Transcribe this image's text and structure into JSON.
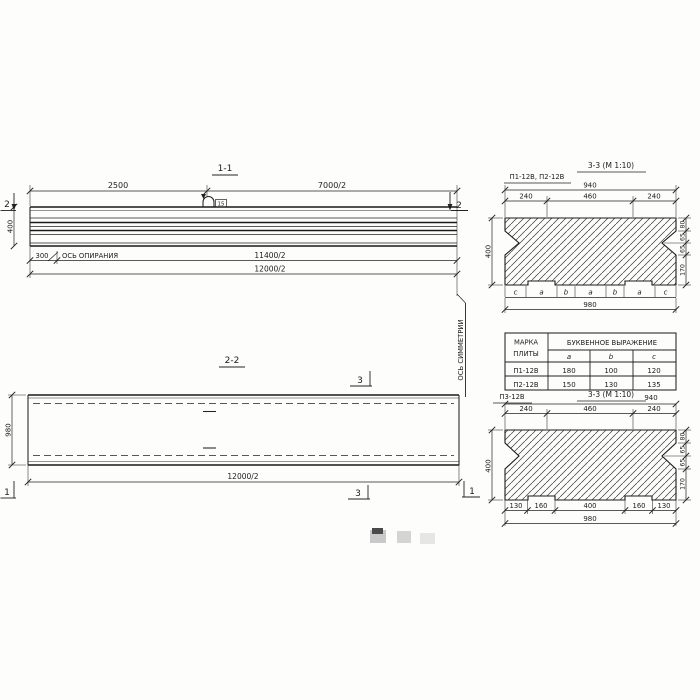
{
  "drawing": {
    "elevation": {
      "title": "1-1",
      "dim_2500": "2500",
      "dim_7000_2": "7000/2",
      "dim_400": "400",
      "dim_300": "300",
      "support_axis": "ОСЬ ОПИРАНИЯ",
      "dim_11400_2": "11400/2",
      "dim_12000_2": "12000/2",
      "marker_left": "2",
      "marker_right": "2",
      "loop_tag": "15"
    },
    "symmetry_axis": "ОСЬ СИММЕТРИИ",
    "plan": {
      "title": "2-2",
      "dim_980": "980",
      "dim_12000_2": "12000/2",
      "marker_top": "3",
      "marker_bottom": "3",
      "marker_left": "1",
      "marker_right": "1"
    },
    "section_a": {
      "label": "П1-12В, П2-12В",
      "title": "3-3 (М 1:10)",
      "dim_940": "940",
      "top_dims": [
        "240",
        "460",
        "240"
      ],
      "left_dim": "400",
      "right_dims": [
        "80",
        "65",
        "65",
        "170"
      ],
      "letters": [
        "c",
        "a",
        "b",
        "a",
        "b",
        "a",
        "c"
      ],
      "dim_980": "980"
    },
    "table": {
      "header_mark_1": "МАРКА",
      "header_mark_2": "ПЛИТЫ",
      "header_expr": "БУКВЕННОЕ  ВЫРАЖЕНИЕ",
      "cols": [
        "a",
        "b",
        "c"
      ],
      "rows": [
        {
          "mark": "П1-12В",
          "a": "180",
          "b": "100",
          "c": "120"
        },
        {
          "mark": "П2-12В",
          "a": "150",
          "b": "130",
          "c": "135"
        }
      ]
    },
    "section_b": {
      "label": "П3-12В",
      "title": "3-3 (М 1:10)",
      "dim_940": "940",
      "top_dims": [
        "240",
        "460",
        "240"
      ],
      "left_dim": "400",
      "right_dims": [
        "80",
        "65",
        "65",
        "170"
      ],
      "bottom_dims": [
        "130",
        "160",
        "400",
        "160",
        "130"
      ],
      "dim_980": "980"
    }
  }
}
